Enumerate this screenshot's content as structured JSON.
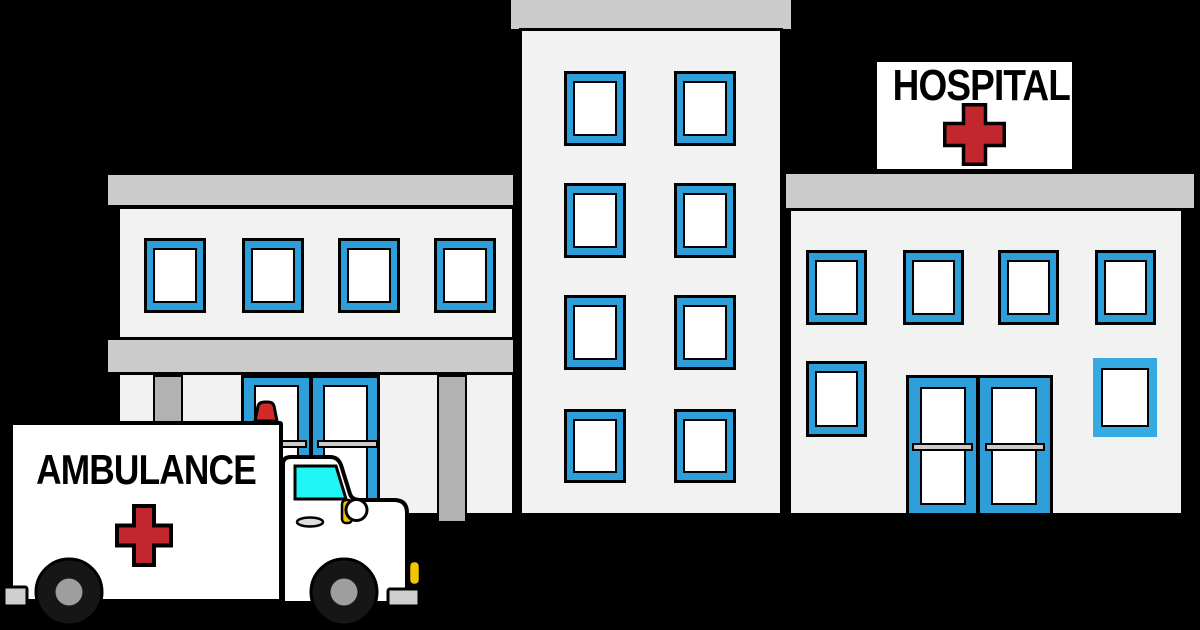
{
  "scene_title": "Hospital building with ambulance (clip art)",
  "sign": {
    "label": "HOSPITAL",
    "cross_icon": "red-cross"
  },
  "ambulance": {
    "label": "AMBULANCE",
    "cross_icon": "red-cross",
    "siren_icon": "emergency-light"
  },
  "buildings": {
    "left_wing": {
      "upper_windows": 4,
      "doors": 2,
      "pillars": 2,
      "roof_ledges": 2
    },
    "tower": {
      "window_rows": 4,
      "window_cols": 2,
      "roof_cap": 1
    },
    "right_wing": {
      "upper_windows": 4,
      "lower_windows": 2,
      "doors": 2,
      "roof_ledges": 1
    }
  },
  "colors": {
    "background": "#000000",
    "ink": "#000000",
    "facade": "#F2F2F2",
    "ledge": "#CCCCCC",
    "pillar": "#B2B2B2",
    "window_blue": "#2D9ED8",
    "window_blue_light": "#36ABE2",
    "pane_white": "#FFFFFF",
    "cross_red": "#C1272D",
    "siren_red": "#CF2B2B",
    "windshield_cyan": "#20F6F6",
    "headlight_yellow": "#F2C500",
    "bumper_gray": "#CFCFCF",
    "handle_gray": "#DEDEDE",
    "tire_black": "#161616",
    "hub_gray": "#9E9E9E"
  }
}
